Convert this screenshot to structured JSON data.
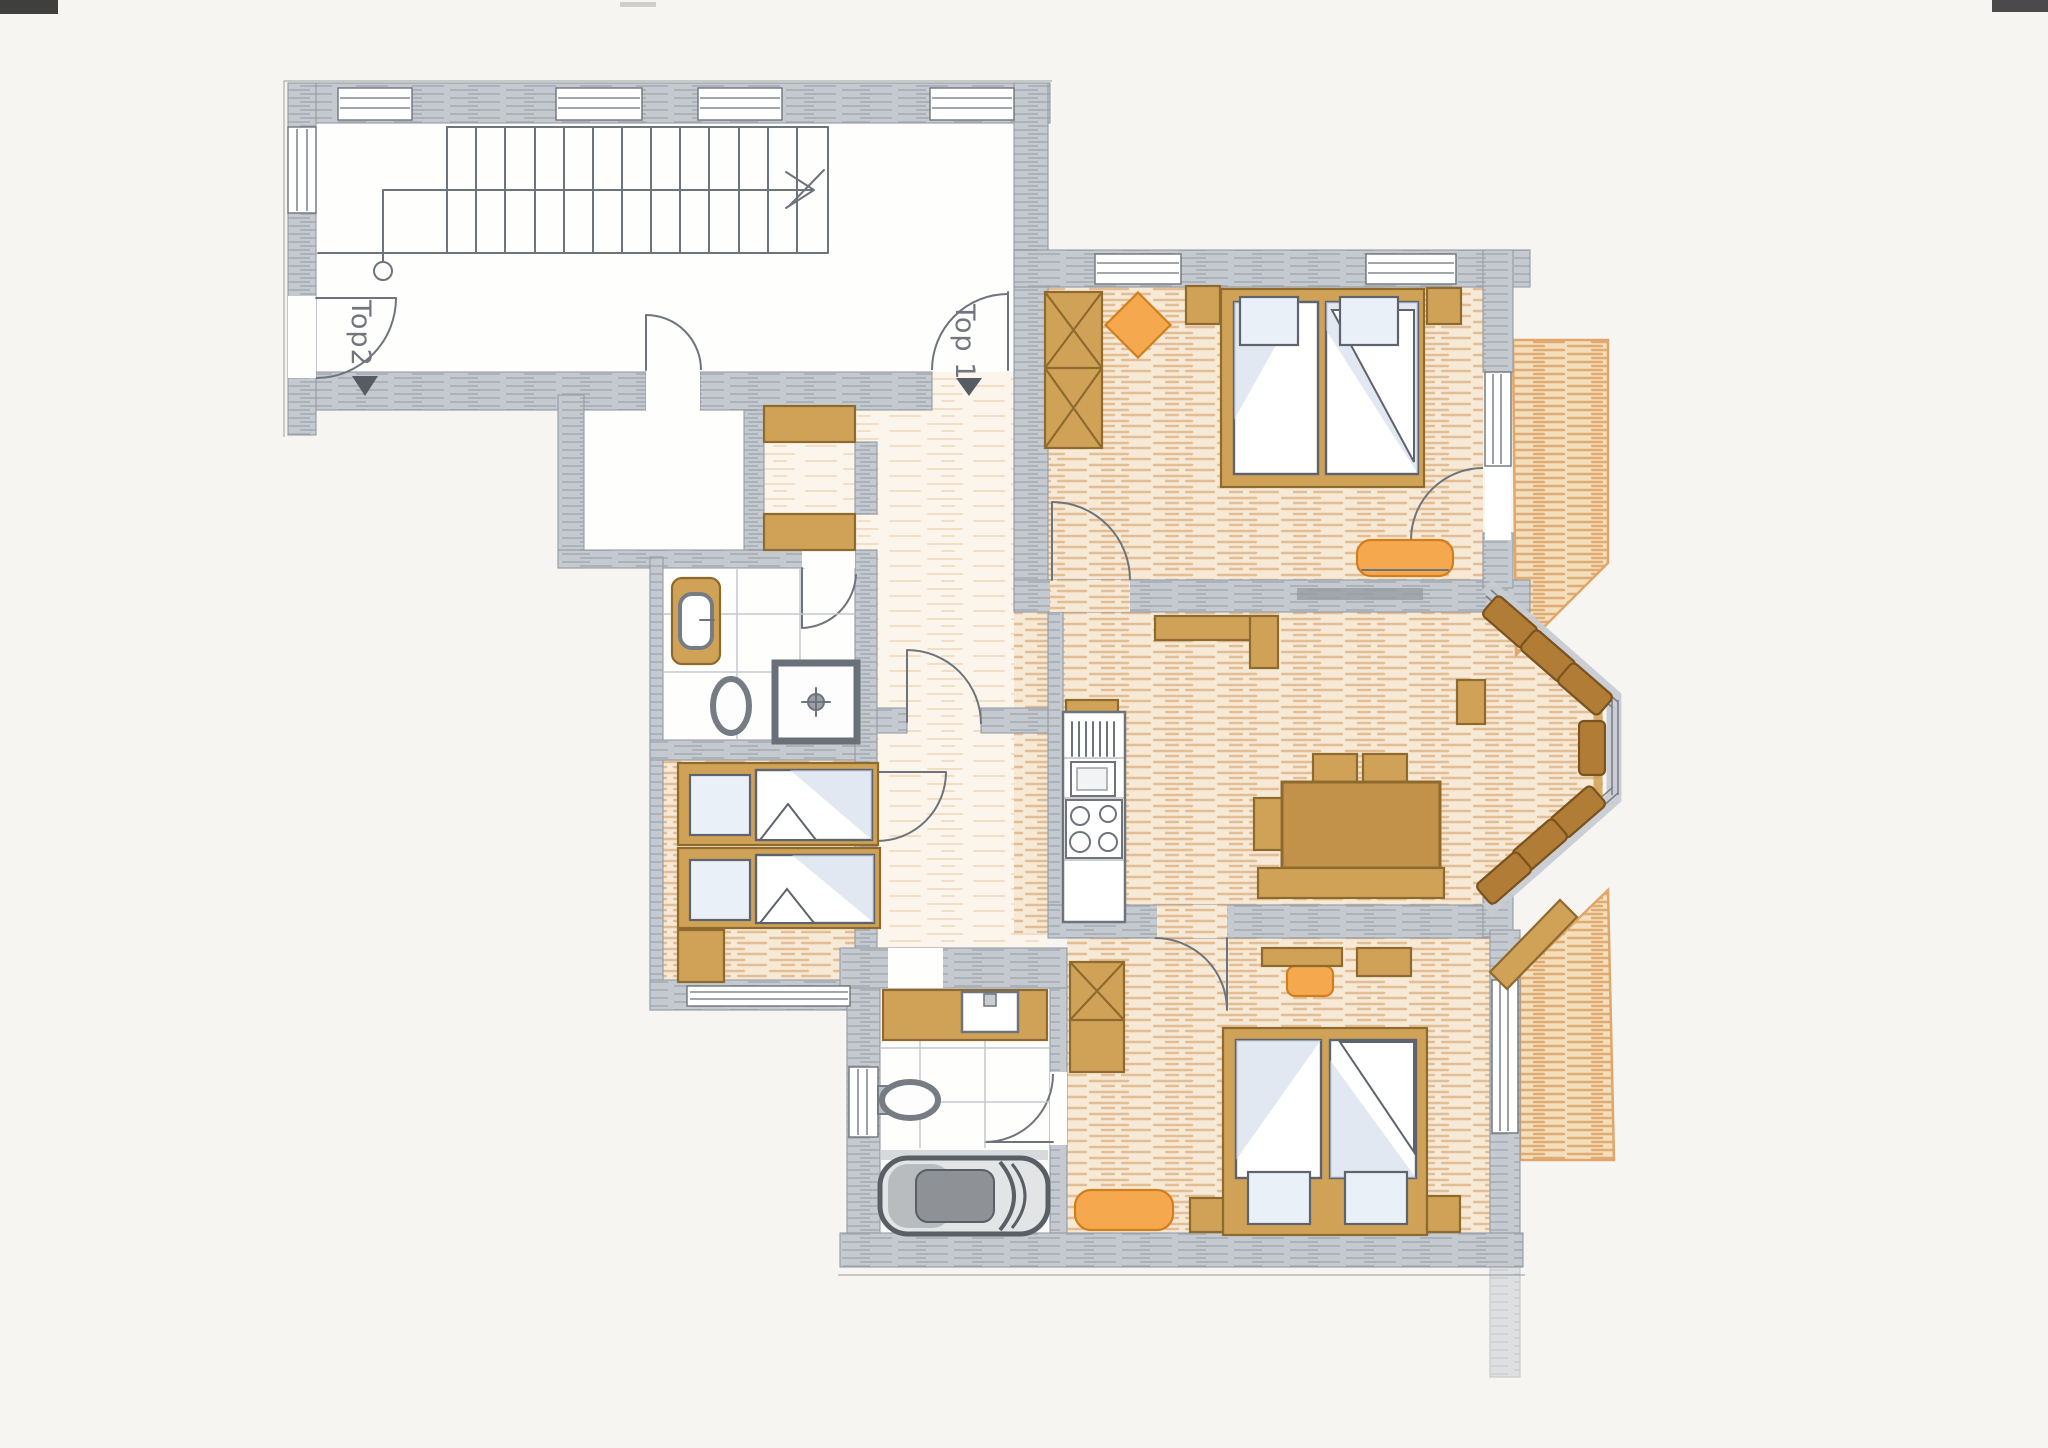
{
  "page": {
    "background": "#f6f5f2"
  },
  "floor_plan": {
    "kind": "hand-drawn apartment floor plan (scanned colored-pencil drawing)",
    "entrance_labels": [
      {
        "id": "top1",
        "text": "Top 1"
      },
      {
        "id": "top2",
        "text": "Top2"
      }
    ],
    "colors": {
      "pageBg": "#f6f5f2",
      "wall": "#c5cad0",
      "wallHatch": "#a9afb7",
      "pencil": "#6e747c",
      "floorBase": "#f6ead6",
      "floorStroke": "#dfb183",
      "floorBase2": "#fbf5eb",
      "floorStroke2": "#e8cba4",
      "deckBase": "#f4dfbd",
      "deckStroke": "#dfa76b",
      "wood": "#cfa258",
      "woodMid": "#c2924a",
      "woodDark": "#8f6a2d",
      "benchBrown": "#b07c36",
      "benchEdge": "#7b531e",
      "orange": "#f5a84e",
      "orangeEdge": "#d07f1f",
      "matShade": "#c9d6e8",
      "pillowFill": "#eaf0f8",
      "label": "#71767e",
      "artifact": "#1f1f1f"
    }
  }
}
